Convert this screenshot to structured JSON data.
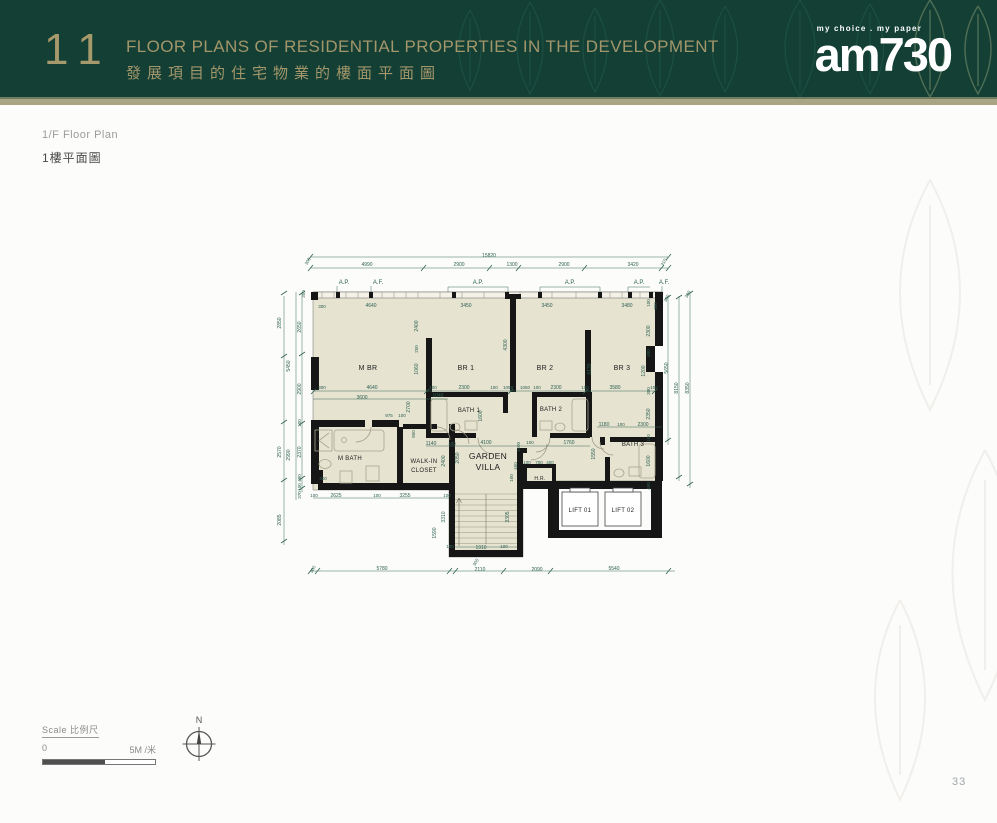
{
  "header": {
    "chapter_number": "11",
    "title_en": "FLOOR PLANS OF RESIDENTIAL PROPERTIES IN THE DEVELOPMENT",
    "title_zh": "發展項目的住宅物業的樓面平面圖",
    "logo_tagline": "my choice . my paper",
    "logo_name": "am730",
    "colors": {
      "background": "#133f35",
      "gold": "#a3966a",
      "bar": "#a9a584"
    }
  },
  "subheading": {
    "line_en": "1/F Floor Plan",
    "line_zh": "1樓平面圖"
  },
  "floor_plan": {
    "overall_width": "15820",
    "room_labels": [
      {
        "t": "M BR",
        "x": 368,
        "y": 370
      },
      {
        "t": "BR 1",
        "x": 466,
        "y": 370
      },
      {
        "t": "BR 2",
        "x": 545,
        "y": 370
      },
      {
        "t": "BR 3",
        "x": 622,
        "y": 370
      },
      {
        "t": "BATH 1",
        "x": 469,
        "y": 412,
        "s": 6
      },
      {
        "t": "BATH 2",
        "x": 551,
        "y": 411,
        "s": 6
      },
      {
        "t": "BATH 3",
        "x": 633,
        "y": 446,
        "s": 6
      },
      {
        "t": "M BATH",
        "x": 350,
        "y": 460,
        "s": 6
      },
      {
        "t": "WALK-IN",
        "x": 424,
        "y": 463,
        "s": 6
      },
      {
        "t": "CLOSET",
        "x": 424,
        "y": 472,
        "s": 6
      },
      {
        "t": "GARDEN",
        "x": 488,
        "y": 459,
        "s": 8.5
      },
      {
        "t": "VILLA",
        "x": 488,
        "y": 470,
        "s": 8.5
      },
      {
        "t": "H.R.",
        "x": 540,
        "y": 480,
        "s": 5
      },
      {
        "t": "LIFT 01",
        "x": 580,
        "y": 512,
        "s": 6
      },
      {
        "t": "LIFT 02",
        "x": 623,
        "y": 512,
        "s": 6
      }
    ],
    "dimension_texts": [
      {
        "t": "15820",
        "x": 489,
        "y": 257
      },
      {
        "t": "4990",
        "x": 367,
        "y": 266
      },
      {
        "t": "2900",
        "x": 459,
        "y": 266
      },
      {
        "t": "1300",
        "x": 512,
        "y": 266
      },
      {
        "t": "2900",
        "x": 564,
        "y": 266
      },
      {
        "t": "3420",
        "x": 633,
        "y": 266
      },
      {
        "t": "310",
        "x": 665,
        "y": 263,
        "r": 300,
        "s": 4.5
      },
      {
        "t": "A.P.",
        "x": 344,
        "y": 284,
        "s": 6
      },
      {
        "t": "A.F.",
        "x": 378,
        "y": 284,
        "s": 6
      },
      {
        "t": "A.P.",
        "x": 478,
        "y": 284,
        "s": 6
      },
      {
        "t": "A.P.",
        "x": 570,
        "y": 284,
        "s": 6
      },
      {
        "t": "A.P.",
        "x": 639,
        "y": 284,
        "s": 6
      },
      {
        "t": "A.F.",
        "x": 664,
        "y": 284,
        "s": 6
      },
      {
        "t": "300",
        "x": 322,
        "y": 308,
        "s": 4.5
      },
      {
        "t": "4640",
        "x": 371,
        "y": 307
      },
      {
        "t": "3450",
        "x": 466,
        "y": 307
      },
      {
        "t": "3450",
        "x": 547,
        "y": 307
      },
      {
        "t": "3480",
        "x": 627,
        "y": 307
      },
      {
        "t": "300",
        "x": 322,
        "y": 389,
        "s": 4.5
      },
      {
        "t": "4640",
        "x": 372,
        "y": 389
      },
      {
        "t": "100",
        "x": 433,
        "y": 389,
        "s": 4.5
      },
      {
        "t": "2300",
        "x": 464,
        "y": 389
      },
      {
        "t": "100",
        "x": 494,
        "y": 389,
        "s": 4.5
      },
      {
        "t": "1050",
        "x": 508,
        "y": 389,
        "s": 4.5
      },
      {
        "t": "1050",
        "x": 525,
        "y": 389,
        "s": 4.5
      },
      {
        "t": "100",
        "x": 537,
        "y": 389,
        "s": 4.5
      },
      {
        "t": "2300",
        "x": 556,
        "y": 389
      },
      {
        "t": "100",
        "x": 585,
        "y": 389,
        "s": 4.5
      },
      {
        "t": "3580",
        "x": 615,
        "y": 389
      },
      {
        "t": "100",
        "x": 654,
        "y": 389,
        "s": 4.5
      },
      {
        "t": "3600",
        "x": 362,
        "y": 399
      },
      {
        "t": "1040",
        "x": 438,
        "y": 397
      },
      {
        "t": "975",
        "x": 389,
        "y": 417,
        "s": 4.5
      },
      {
        "t": "100",
        "x": 402,
        "y": 417,
        "s": 4.5
      },
      {
        "t": "1140",
        "x": 431,
        "y": 445
      },
      {
        "t": "100",
        "x": 452,
        "y": 445,
        "s": 4.5
      },
      {
        "t": "4100",
        "x": 486,
        "y": 444
      },
      {
        "t": "100",
        "x": 530,
        "y": 444,
        "s": 4.5
      },
      {
        "t": "1760",
        "x": 569,
        "y": 444
      },
      {
        "t": "1180",
        "x": 604,
        "y": 426
      },
      {
        "t": "100",
        "x": 621,
        "y": 426,
        "s": 4.5
      },
      {
        "t": "2300",
        "x": 643,
        "y": 426
      },
      {
        "t": "100",
        "x": 527,
        "y": 464,
        "s": 4.5
      },
      {
        "t": "700",
        "x": 539,
        "y": 464,
        "s": 4.5
      },
      {
        "t": "400",
        "x": 550,
        "y": 464,
        "s": 4.5
      },
      {
        "t": "100",
        "x": 314,
        "y": 497,
        "s": 4.5
      },
      {
        "t": "2625",
        "x": 336,
        "y": 497
      },
      {
        "t": "100",
        "x": 377,
        "y": 497,
        "s": 4.5
      },
      {
        "t": "3255",
        "x": 405,
        "y": 497
      },
      {
        "t": "100",
        "x": 447,
        "y": 497,
        "s": 4.5
      },
      {
        "t": "100",
        "x": 450,
        "y": 548,
        "s": 4.5
      },
      {
        "t": "1910",
        "x": 481,
        "y": 549
      },
      {
        "t": "100",
        "x": 504,
        "y": 548,
        "s": 4.5
      },
      {
        "t": "300",
        "x": 314,
        "y": 570,
        "r": 300,
        "s": 4.5
      },
      {
        "t": "5780",
        "x": 382,
        "y": 570
      },
      {
        "t": "300",
        "x": 477,
        "y": 563,
        "r": 300,
        "s": 4.5
      },
      {
        "t": "2110",
        "x": 480,
        "y": 571
      },
      {
        "t": "2090",
        "x": 537,
        "y": 571
      },
      {
        "t": "5540",
        "x": 614,
        "y": 570
      },
      {
        "t": "300",
        "x": 309,
        "y": 262,
        "r": 300,
        "s": 4.5
      },
      {
        "t": "350",
        "x": 305,
        "y": 294,
        "r": 270,
        "s": 4.5
      },
      {
        "t": "2850",
        "x": 281,
        "y": 323,
        "r": 270
      },
      {
        "t": "2570",
        "x": 281,
        "y": 452,
        "r": 270
      },
      {
        "t": "2085",
        "x": 281,
        "y": 520,
        "r": 270
      },
      {
        "t": "5450",
        "x": 290,
        "y": 366,
        "r": 270
      },
      {
        "t": "2990",
        "x": 290,
        "y": 455,
        "r": 270
      },
      {
        "t": "2650",
        "x": 301,
        "y": 327,
        "r": 270
      },
      {
        "t": "2900",
        "x": 301,
        "y": 389,
        "r": 270
      },
      {
        "t": "100",
        "x": 301,
        "y": 423,
        "r": 270,
        "s": 4.5
      },
      {
        "t": "2370",
        "x": 301,
        "y": 452,
        "r": 270
      },
      {
        "t": "480",
        "x": 301,
        "y": 478,
        "r": 270,
        "s": 4.5
      },
      {
        "t": "100",
        "x": 301,
        "y": 487,
        "r": 270,
        "s": 4.5
      },
      {
        "t": "370",
        "x": 301,
        "y": 495,
        "r": 270,
        "s": 4.5
      },
      {
        "t": "300",
        "x": 323,
        "y": 480,
        "s": 4.5
      },
      {
        "t": "5650",
        "x": 668,
        "y": 368,
        "r": 270
      },
      {
        "t": "8150",
        "x": 678,
        "y": 388,
        "r": 270
      },
      {
        "t": "8350",
        "x": 689,
        "y": 388,
        "r": 270
      },
      {
        "t": "300",
        "x": 668,
        "y": 299,
        "r": 300,
        "s": 4.5
      },
      {
        "t": "300",
        "x": 689,
        "y": 295,
        "r": 300,
        "s": 4.5
      },
      {
        "t": "100",
        "x": 650,
        "y": 303,
        "r": 270,
        "s": 4.5
      },
      {
        "t": "200",
        "x": 657,
        "y": 306,
        "r": 270,
        "s": 4.5
      },
      {
        "t": "2300",
        "x": 650,
        "y": 331,
        "r": 270
      },
      {
        "t": "400",
        "x": 650,
        "y": 353,
        "r": 270,
        "s": 4.5
      },
      {
        "t": "1200",
        "x": 645,
        "y": 371,
        "r": 270
      },
      {
        "t": "300",
        "x": 650,
        "y": 391,
        "r": 270,
        "s": 4.5
      },
      {
        "t": "2350",
        "x": 650,
        "y": 414,
        "r": 270
      },
      {
        "t": "100",
        "x": 650,
        "y": 438,
        "r": 270,
        "s": 4.5
      },
      {
        "t": "1600",
        "x": 650,
        "y": 461,
        "r": 270
      },
      {
        "t": "400",
        "x": 650,
        "y": 486,
        "r": 270,
        "s": 4.5
      },
      {
        "t": "2400",
        "x": 418,
        "y": 326,
        "r": 270
      },
      {
        "t": "250",
        "x": 418,
        "y": 349,
        "r": 270,
        "s": 4.5
      },
      {
        "t": "1060",
        "x": 418,
        "y": 369,
        "r": 270
      },
      {
        "t": "2700",
        "x": 410,
        "y": 407,
        "r": 270
      },
      {
        "t": "850",
        "x": 415,
        "y": 434,
        "r": 270,
        "s": 4.5
      },
      {
        "t": "4300",
        "x": 507,
        "y": 345,
        "r": 270
      },
      {
        "t": "1600",
        "x": 482,
        "y": 416,
        "r": 270
      },
      {
        "t": "6130",
        "x": 591,
        "y": 369,
        "r": 270
      },
      {
        "t": "2050",
        "x": 459,
        "y": 458,
        "r": 270
      },
      {
        "t": "2400",
        "x": 445,
        "y": 461,
        "r": 270
      },
      {
        "t": "1500",
        "x": 520,
        "y": 447,
        "r": 270,
        "s": 4.5
      },
      {
        "t": "450",
        "x": 517,
        "y": 466,
        "r": 270,
        "s": 4.5
      },
      {
        "t": "100",
        "x": 513,
        "y": 478,
        "r": 270,
        "s": 4.5
      },
      {
        "t": "1550",
        "x": 595,
        "y": 454,
        "r": 270
      },
      {
        "t": "3310",
        "x": 445,
        "y": 517,
        "r": 270
      },
      {
        "t": "3305",
        "x": 509,
        "y": 517,
        "r": 270
      },
      {
        "t": "1590",
        "x": 436,
        "y": 533,
        "r": 270
      }
    ]
  },
  "scale": {
    "title": "Scale 比例尺",
    "start": "0",
    "end": "5M /米"
  },
  "north": {
    "label": "N"
  },
  "page_number": "33"
}
